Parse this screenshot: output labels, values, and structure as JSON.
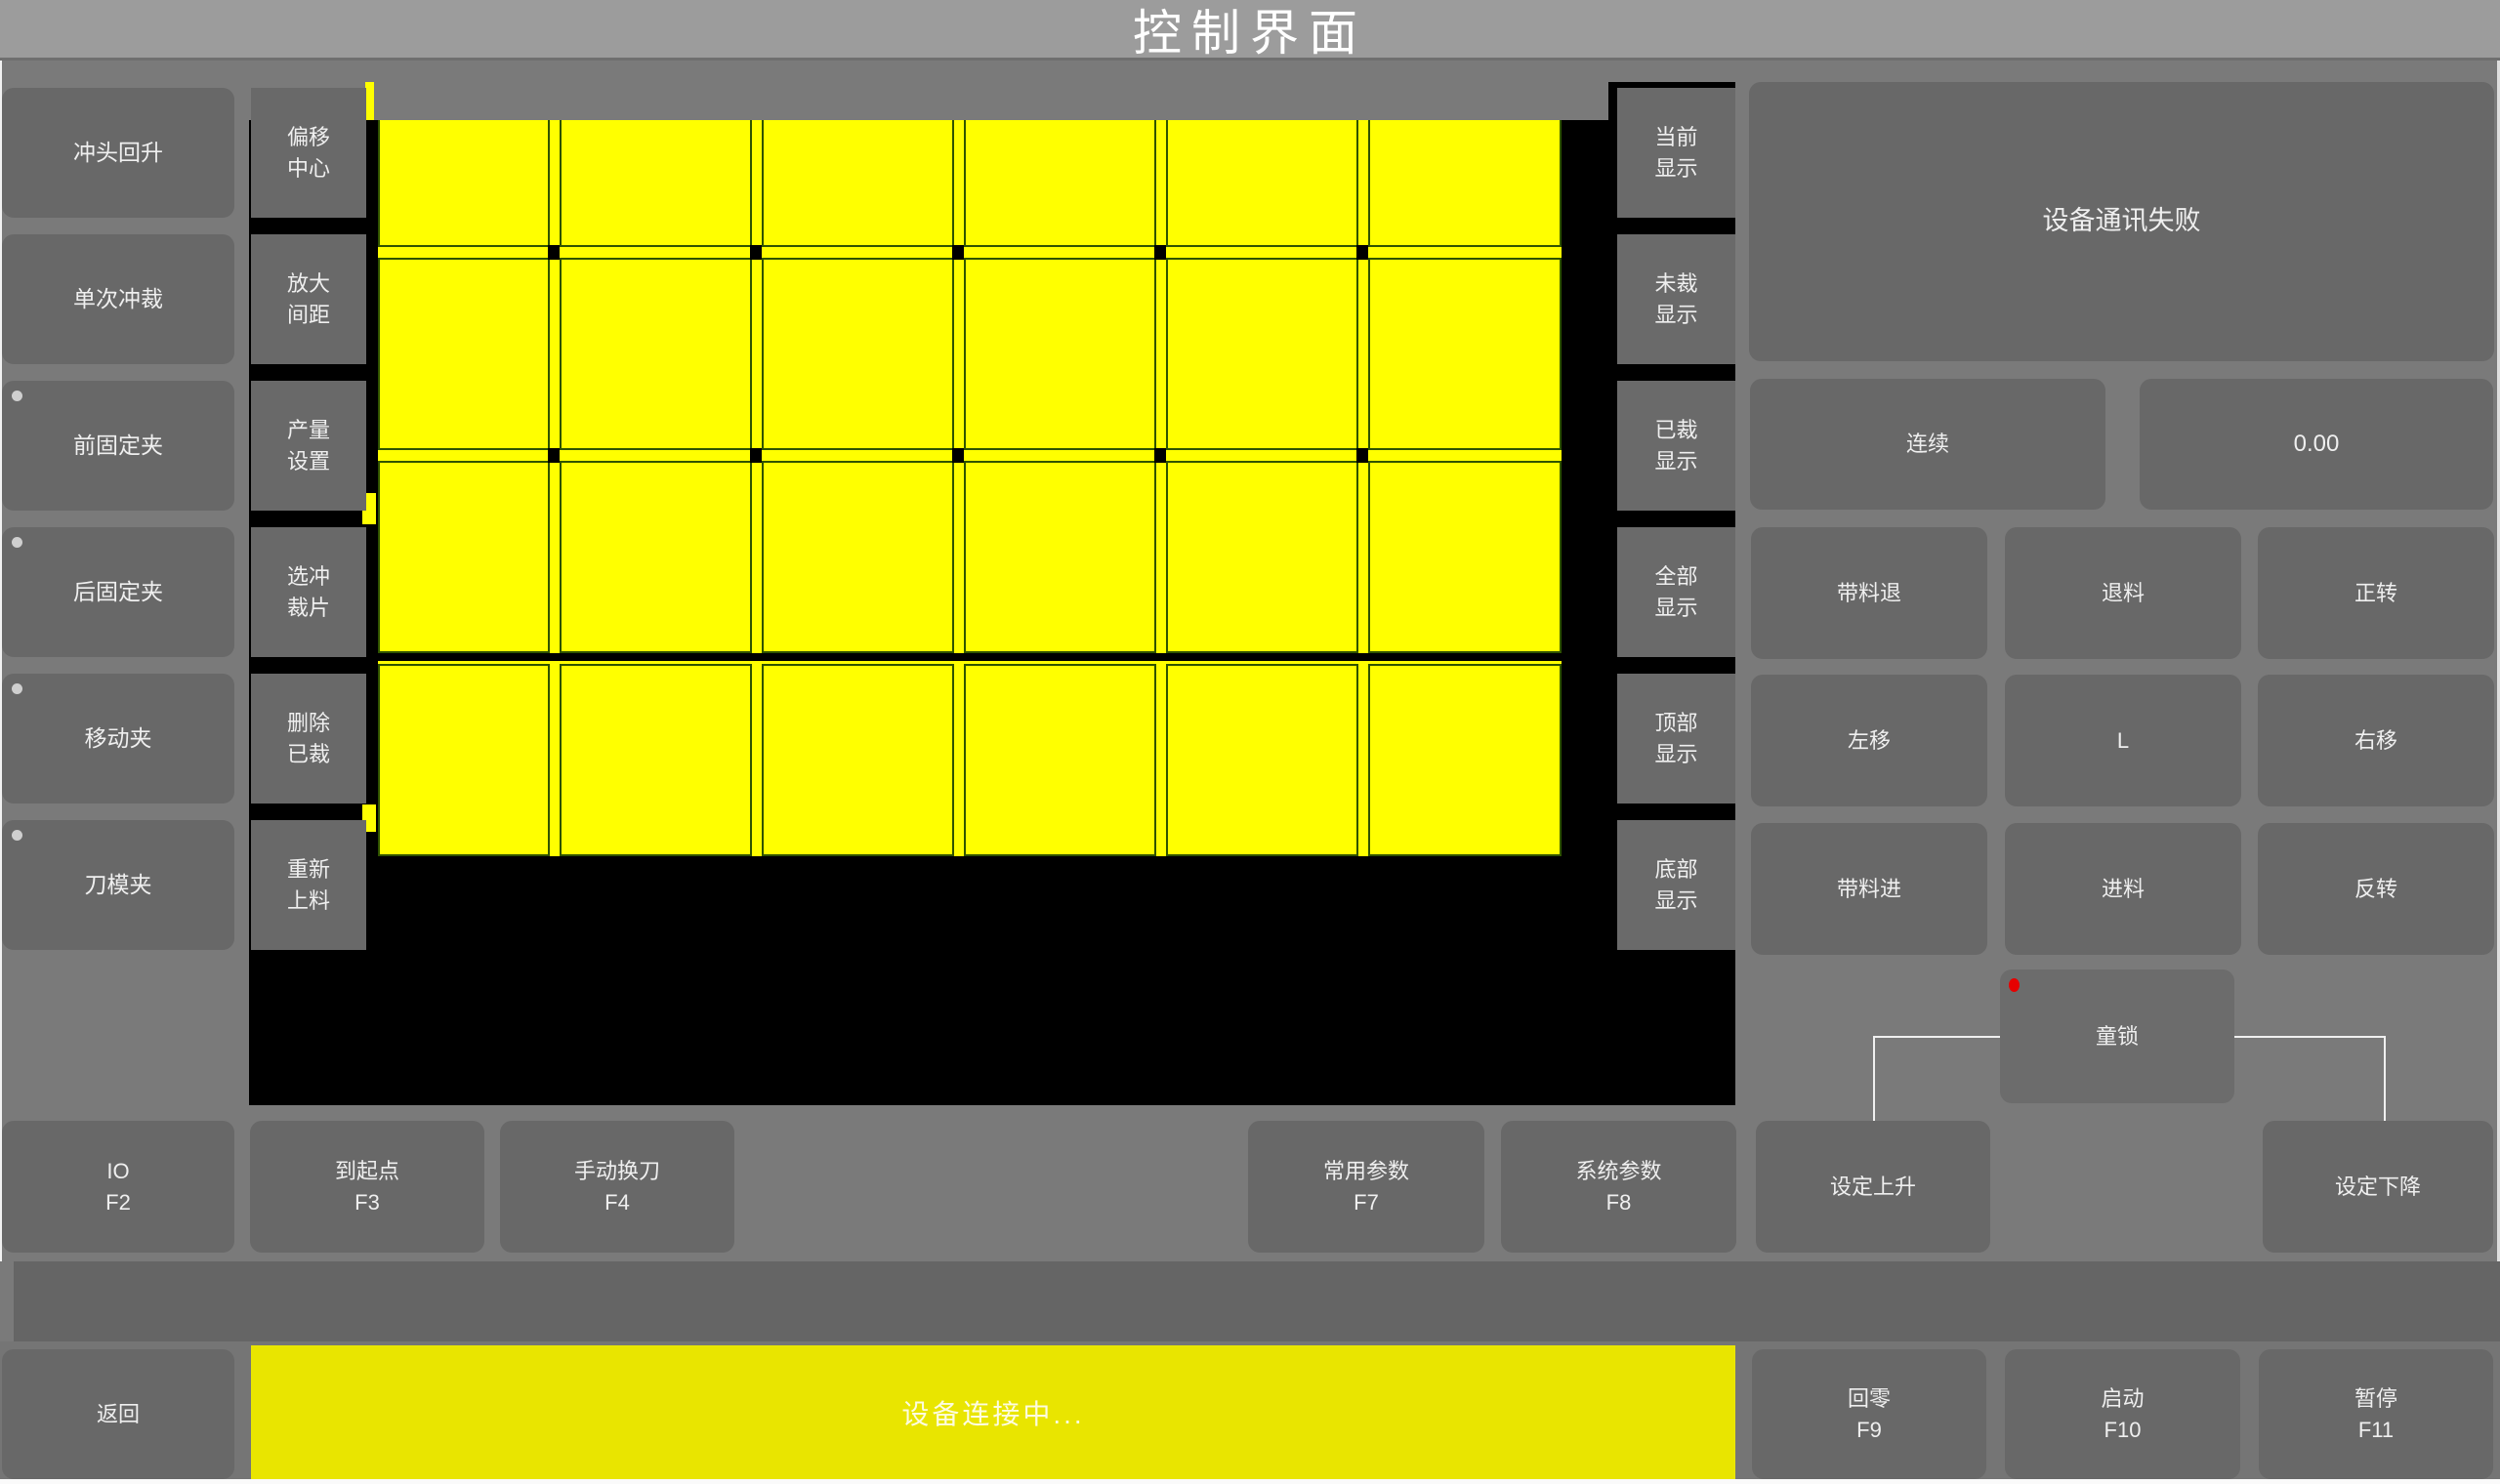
{
  "title": "控制界面",
  "left_column": {
    "buttons": [
      {
        "label": "冲头回升",
        "indicator": false
      },
      {
        "label": "单次冲裁",
        "indicator": false
      },
      {
        "label": "前固定夹",
        "indicator": true
      },
      {
        "label": "后固定夹",
        "indicator": true
      },
      {
        "label": "移动夹",
        "indicator": true
      },
      {
        "label": "刀模夹",
        "indicator": true
      }
    ]
  },
  "tool_column": {
    "buttons": [
      {
        "label": "偏移\n中心"
      },
      {
        "label": "放大\n间距"
      },
      {
        "label": "产量\n设置"
      },
      {
        "label": "选冲\n裁片"
      },
      {
        "label": "删除\n已裁"
      },
      {
        "label": "重新\n上料"
      }
    ]
  },
  "display_column": {
    "buttons": [
      {
        "label": "当前\n显示"
      },
      {
        "label": "未裁\n显示"
      },
      {
        "label": "已裁\n显示"
      },
      {
        "label": "全部\n显示"
      },
      {
        "label": "顶部\n显示"
      },
      {
        "label": "底部\n显示"
      }
    ]
  },
  "canvas": {
    "grid_columns": 6,
    "grid_rows": 4,
    "piece_color": "#ffff00",
    "background_color": "#000000",
    "piece_border_color": "#2f5300"
  },
  "right_panel": {
    "message": "设备通讯失败",
    "mode_label": "连续",
    "value": "0.00",
    "jog": [
      {
        "label": "带料退"
      },
      {
        "label": "退料"
      },
      {
        "label": "正转"
      },
      {
        "label": "左移"
      },
      {
        "label": "L"
      },
      {
        "label": "右移"
      },
      {
        "label": "带料进"
      },
      {
        "label": "进料"
      },
      {
        "label": "反转"
      }
    ],
    "child_lock_label": "童锁"
  },
  "function_row": {
    "buttons": [
      {
        "label": "IO\nF2"
      },
      {
        "label": "到起点\nF3"
      },
      {
        "label": "手动换刀\nF4"
      },
      {
        "label": "常用参数\nF7"
      },
      {
        "label": "系统参数\nF8"
      },
      {
        "label": "设定上升"
      },
      {
        "label": "设定下降"
      }
    ]
  },
  "bottom_bar": {
    "back_label": "返回",
    "status": "设备连接中...",
    "keys": [
      {
        "label": "回零\nF9"
      },
      {
        "label": "启动\nF10"
      },
      {
        "label": "暂停\nF11"
      }
    ]
  },
  "colors": {
    "status_bar_yellow": "#e9e500",
    "piece_yellow": "#ffff00",
    "canvas_black": "#000000",
    "alert_red": "#e60000",
    "indicator_gray": "#cfcfcf",
    "titlebar_gray": "#9c9c9c"
  }
}
